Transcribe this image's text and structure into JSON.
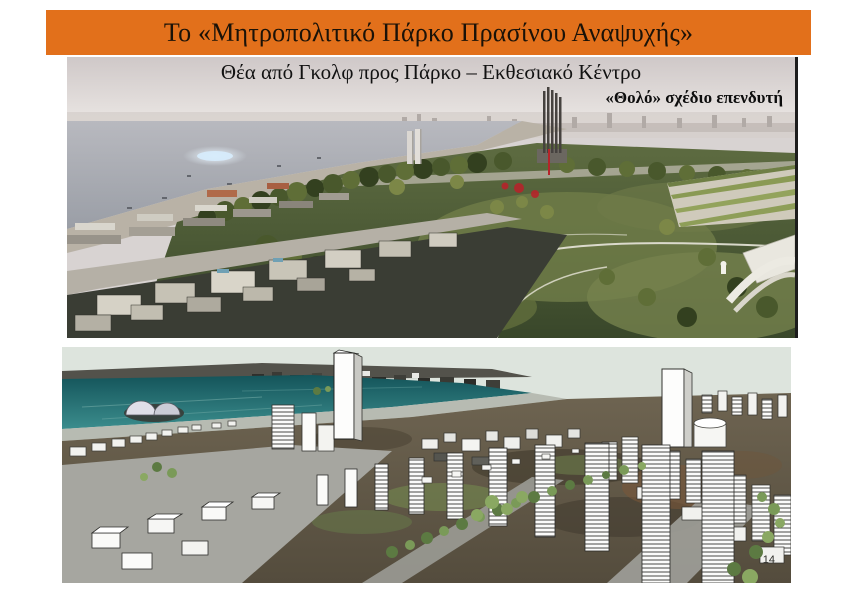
{
  "slide": {
    "title": "Το «Μητροπολιτικό Πάρκο Πρασίνου Αναψυχής»",
    "subtitle": "Θέα από Γκολφ προς Πάρκο – Εκθεσιακό Κέντρο",
    "annotation": "«Θολό» σχέδιο επενδυτή",
    "page_number": "14"
  },
  "colors": {
    "page_bg": "#ffffff",
    "banner_bg": "#e2701b",
    "banner_text": "#1a1208",
    "subtitle_text": "#121212",
    "annotation_text": "#0d0d0d",
    "pagenum_text": "#2c2c28",
    "top_sky": "#dcd6d5",
    "top_sea": "#a9adb4",
    "park_green": "#4c5a33",
    "model_sky": "#dde4dd",
    "model_sea": "#1d6065",
    "model_terrain": "#63594a"
  }
}
